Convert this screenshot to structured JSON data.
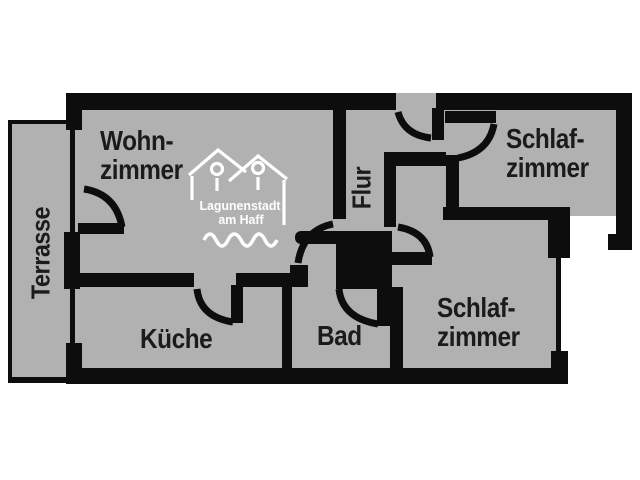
{
  "title": "Apartment floor plan",
  "rooms": {
    "terrasse": {
      "label": "Terrasse"
    },
    "wohnzimmer": {
      "line1": "Wohn-",
      "line2": "zimmer"
    },
    "kueche": {
      "label": "Küche"
    },
    "bad": {
      "label": "Bad"
    },
    "flur": {
      "label": "Flur"
    },
    "schlafzimmer_top": {
      "line1": "Schlaf-",
      "line2": "zimmer"
    },
    "schlafzimmer_bottom": {
      "line1": "Schlaf-",
      "line2": "zimmer"
    }
  },
  "logo": {
    "line1": "Lagunenstadt",
    "line2": "am Haff"
  },
  "colors": {
    "background": "#ffffff",
    "floor": "#b1b1b1",
    "wall": "#0d0d0d",
    "label_text": "#1b1b1b",
    "logo": "#ffffff"
  }
}
